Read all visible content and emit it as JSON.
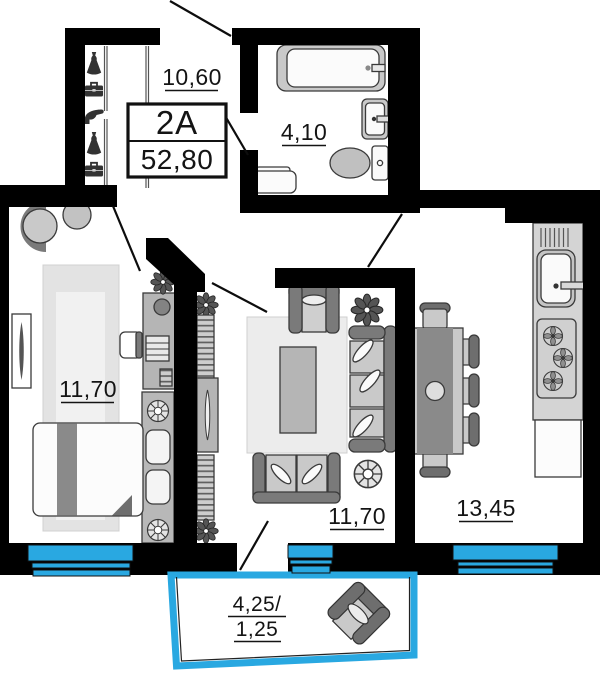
{
  "floor_plan": {
    "unit": {
      "code": "2A",
      "total_area": "52,80"
    },
    "rooms": [
      {
        "id": "hallway",
        "area": "10,60"
      },
      {
        "id": "bathroom",
        "area": "4,10"
      },
      {
        "id": "bedroom",
        "area": "11,70"
      },
      {
        "id": "living-room",
        "area": "11,70"
      },
      {
        "id": "kitchen",
        "area": "13,45"
      },
      {
        "id": "balcony",
        "area_line1": "4,25/",
        "area_line2": "1,25"
      }
    ],
    "colors": {
      "wall": "#000000",
      "glazing": "#29a8e1",
      "furniture_light": "#cdcdcd",
      "furniture_dark": "#6e6e6e"
    },
    "icons": [
      "dress-icon",
      "briefcase-icon",
      "heel-shoe-icon",
      "bathtub-icon",
      "washbasin-icon",
      "toilet-icon",
      "laundry-bench-icon",
      "armchair-icon",
      "side-table-icon",
      "vanity-desk-icon",
      "stool-icon",
      "tv-icon",
      "flower-icon",
      "bed-icon",
      "pillow-icon",
      "bedside-lamp-icon",
      "bookshelf-icon",
      "tv-stand-icon",
      "sofa-icon",
      "loveseat-icon",
      "coffee-table-icon",
      "pouf-icon",
      "dining-table-icon",
      "chair-icon",
      "kitchen-sink-icon",
      "stove-burner-icon",
      "fridge-icon",
      "window-glazing"
    ]
  }
}
